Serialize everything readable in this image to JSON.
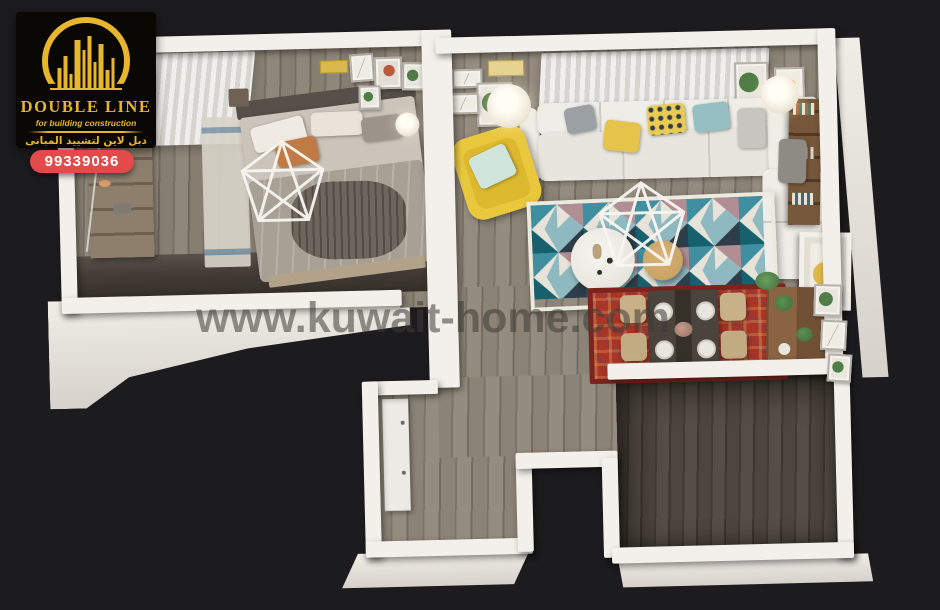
{
  "canvas": {
    "width": 940,
    "height": 600,
    "background": "#1c1c1e"
  },
  "logo": {
    "brand": "DOUBLE LINE",
    "tagline": "for building construction",
    "arabic": "دبل لاين لتشييد المبانى",
    "phone": "99339036",
    "colors": {
      "gold": "#e8b62c",
      "panel": "#0a0805",
      "badge_red": "#e34b4a",
      "badge_text": "#ffffff"
    },
    "icon": "city-buildings-arch-icon"
  },
  "watermark": {
    "text": "www.kuwait-home.com",
    "color": "rgba(62,58,54,0.55)"
  },
  "floorplan": {
    "view": "3d-top-down-apartment-render",
    "wall_color": "#f3f0eb",
    "floor_wood_color": "#867e71",
    "floor_dark_color": "#4d453e",
    "rooms": [
      {
        "id": "bedroom",
        "furniture": [
          "double-bed",
          "wardrobe-shelves",
          "sheer-curtains",
          "geometric-chandelier",
          "wall-art-frames",
          "bedside-lamp",
          "runner-rug"
        ]
      },
      {
        "id": "living-room",
        "furniture": [
          "sectional-sofa",
          "yellow-armchair",
          "triangle-pattern-rug",
          "round-coffee-table",
          "wood-stool",
          "floor-lamp-left",
          "floor-lamp-right",
          "geometric-chandelier",
          "bookshelf",
          "sheer-curtains",
          "wall-art-frames"
        ]
      },
      {
        "id": "dining-area",
        "furniture": [
          "dining-table",
          "dining-chairs",
          "oriental-red-rug",
          "sideboard",
          "plants",
          "botanical-frames"
        ]
      },
      {
        "id": "hallway",
        "furniture": [
          "built-in-closet"
        ]
      },
      {
        "id": "empty-room",
        "furniture": []
      }
    ],
    "accent_colors": {
      "sofa": "#efede7",
      "armchair_yellow": "#e9c83e",
      "rug_teal": "#3f8fa1",
      "rug_dark_teal": "#16616d",
      "rug_mauve": "#b18d94",
      "rug_navy": "#2e3d49",
      "oriental_rug_red": "#a83528",
      "wood_furniture": "#8a6342",
      "bed_duvet": "#a7a095",
      "pillow_orange": "#bf7a45"
    }
  }
}
